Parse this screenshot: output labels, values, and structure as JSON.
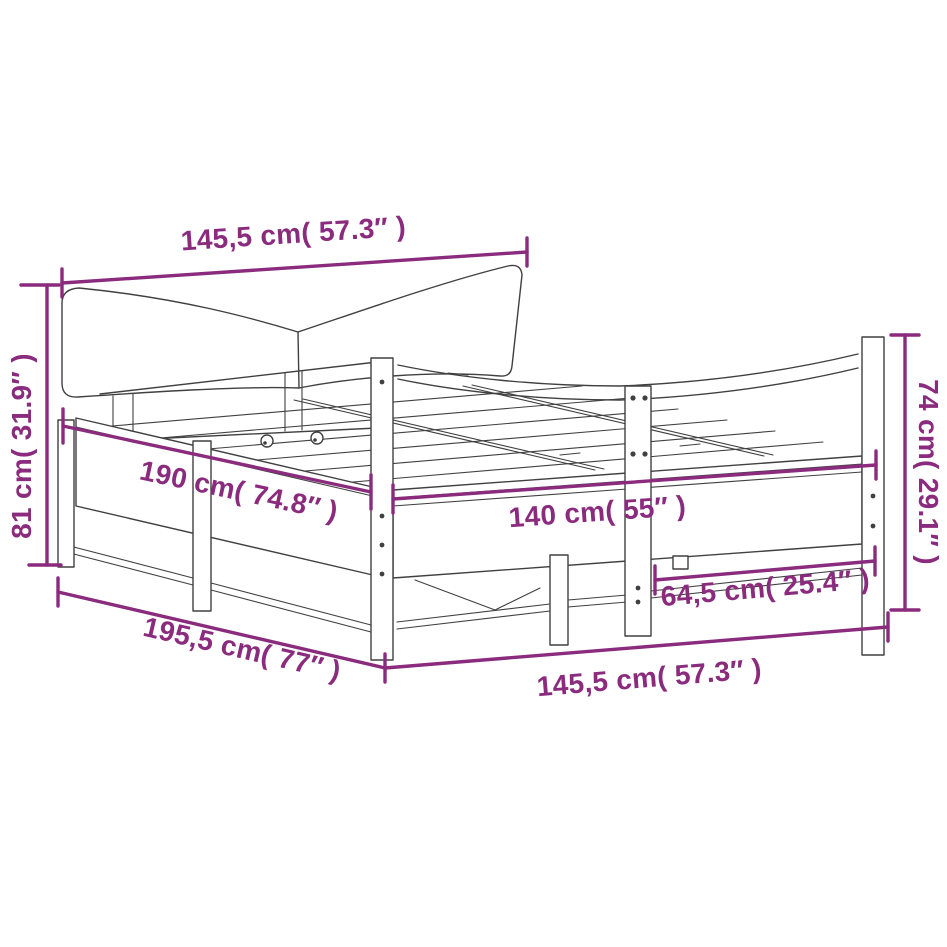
{
  "diagram": {
    "background_color": "#ffffff",
    "artwork_line_color": "#404040",
    "dimension_color": "#8a2b7d",
    "dimensions": {
      "top_width": "145,5 cm( 57.3″ )",
      "left_height": "81 cm( 31.9″ )",
      "inner_length": "190 cm( 74.8″ )",
      "inner_width": "140 cm( 55″ )",
      "right_height": "74 cm( 29.1″ )",
      "leg_spacing": "64,5 cm( 25.4″ )",
      "outer_length": "195,5 cm( 77″ )",
      "bottom_width": "145,5 cm( 57.3″ )"
    }
  }
}
